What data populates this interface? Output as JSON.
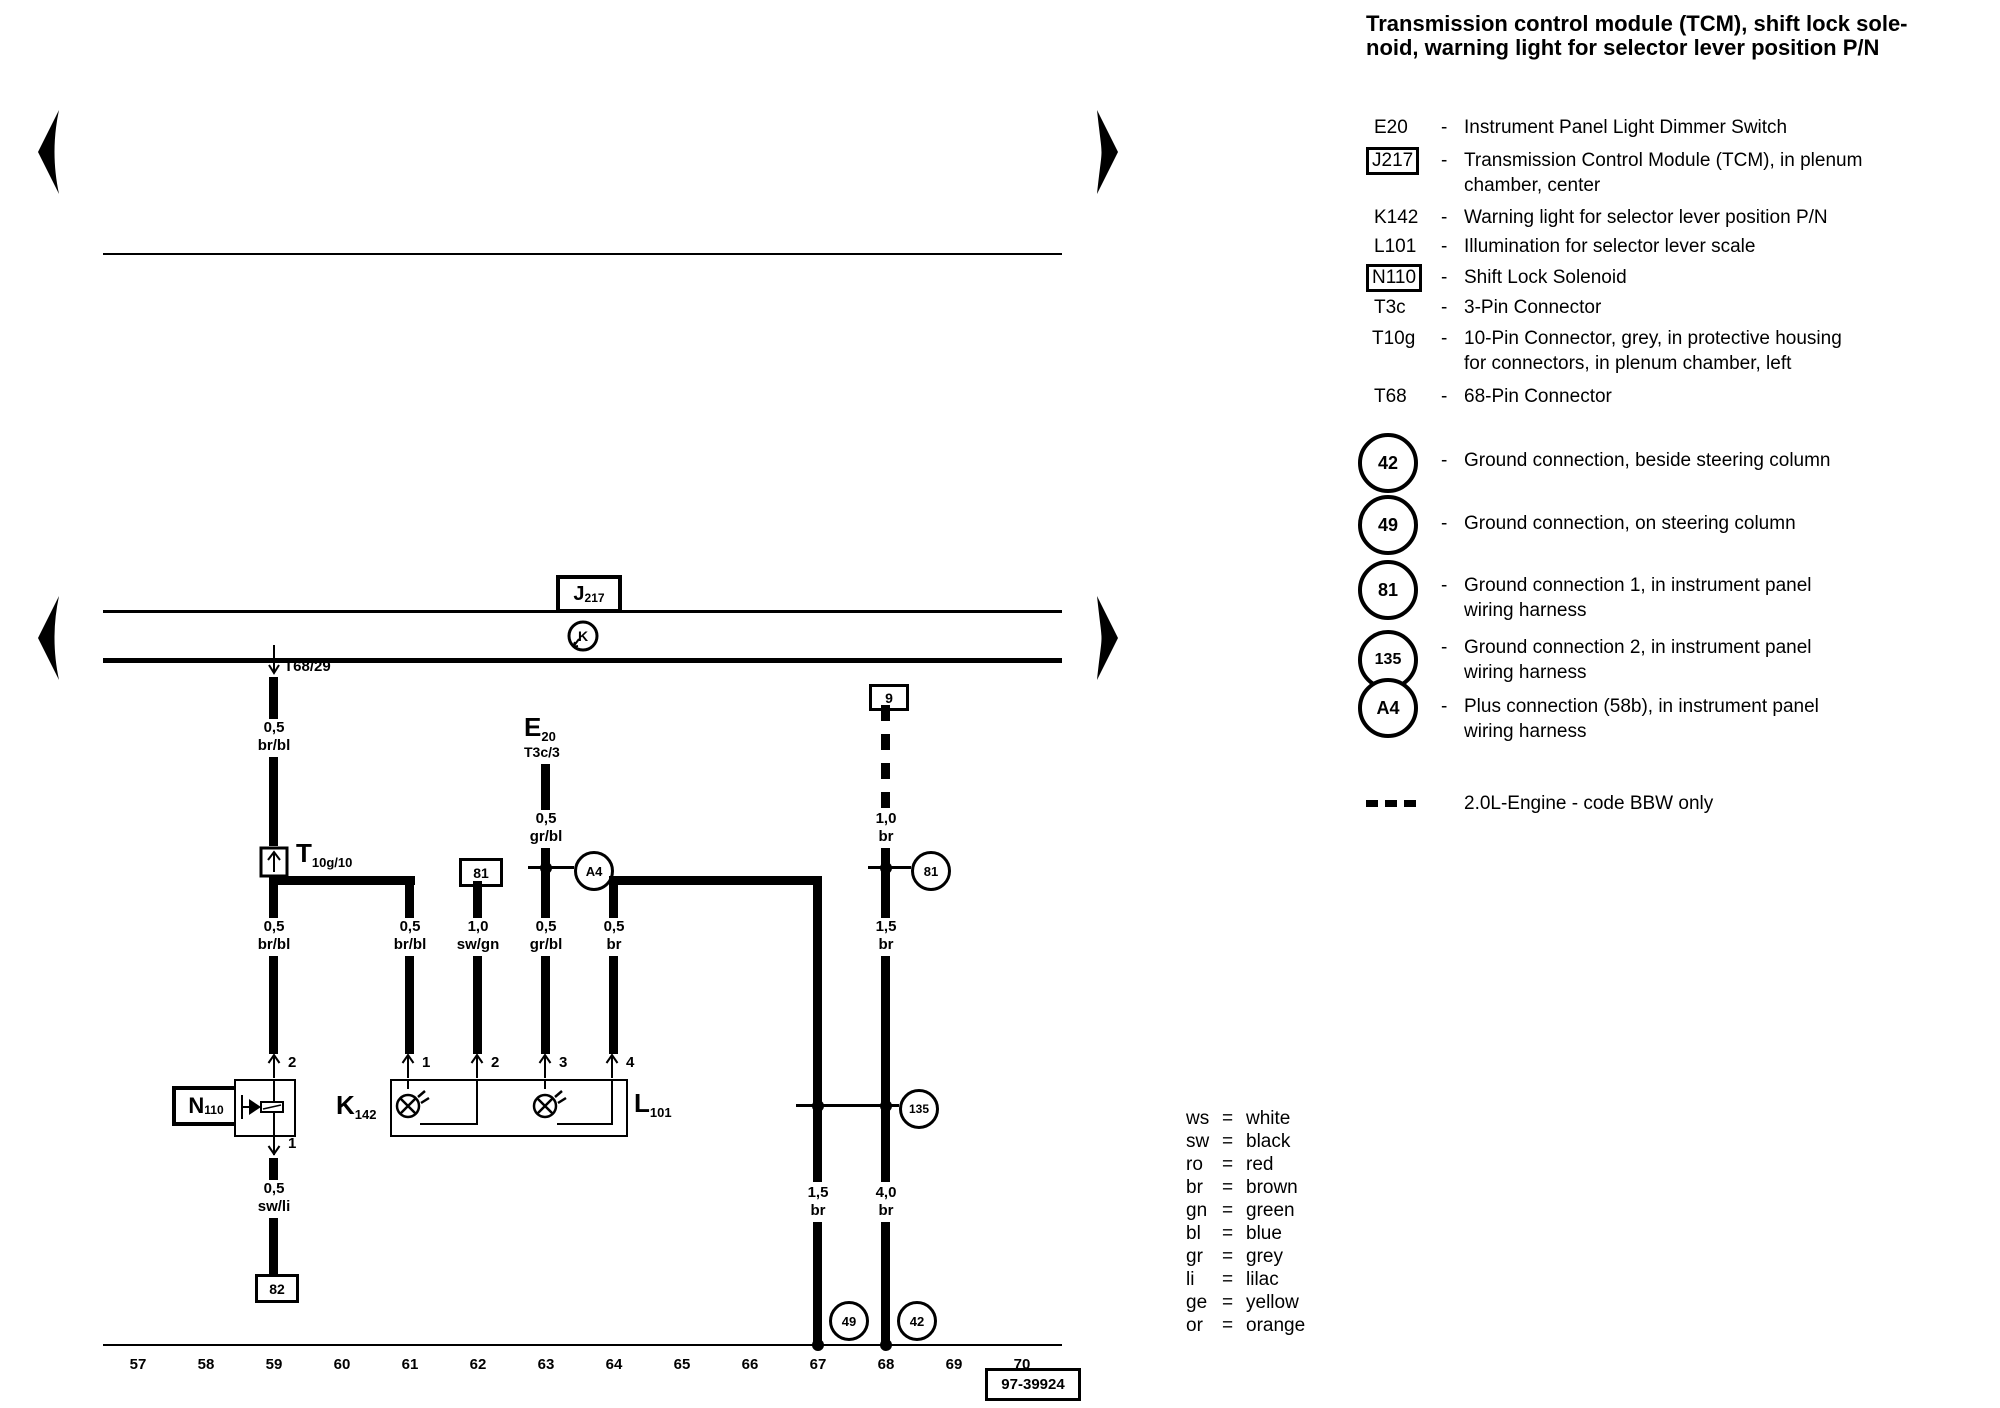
{
  "colors": {
    "ink": "#000000",
    "paper": "#ffffff"
  },
  "title": {
    "line1": "Transmission control module (TCM), shift lock sole-",
    "line2": "noid, warning light for selector lever position P/N"
  },
  "legend": {
    "dash": "-",
    "items": [
      {
        "code": "E20",
        "line1": "Instrument Panel Light Dimmer Switch",
        "line2": ""
      },
      {
        "code": "J217",
        "line1": "Transmission Control Module (TCM), in plenum",
        "line2": "chamber, center"
      },
      {
        "code": "K142",
        "line1": "Warning light for selector lever position P/N",
        "line2": ""
      },
      {
        "code": "L101",
        "line1": "Illumination for selector lever scale",
        "line2": ""
      },
      {
        "code": "N110",
        "line1": "Shift Lock Solenoid",
        "line2": ""
      },
      {
        "code": "T3c",
        "line1": "3-Pin Connector",
        "line2": ""
      },
      {
        "code": "T10g",
        "line1": "10-Pin Connector, grey, in protective housing",
        "line2": "for connectors, in plenum chamber, left"
      },
      {
        "code": "T68",
        "line1": "68-Pin Connector",
        "line2": ""
      }
    ]
  },
  "grounds": {
    "dash": "-",
    "items": [
      {
        "id": "42",
        "line1": "Ground connection, beside steering column",
        "line2": ""
      },
      {
        "id": "49",
        "line1": "Ground connection, on steering column",
        "line2": ""
      },
      {
        "id": "81",
        "line1": "Ground connection 1, in instrument panel",
        "line2": "wiring harness"
      },
      {
        "id": "135",
        "line1": "Ground connection 2, in instrument panel",
        "line2": "wiring harness"
      },
      {
        "id": "A4",
        "line1": "Plus connection (58b), in instrument panel",
        "line2": "wiring harness"
      }
    ]
  },
  "engine_note": "2.0L-Engine - code BBW only",
  "wire_colors": {
    "equals": "=",
    "items": [
      {
        "abbr": "ws",
        "name": "white"
      },
      {
        "abbr": "sw",
        "name": "black"
      },
      {
        "abbr": "ro",
        "name": "red"
      },
      {
        "abbr": "br",
        "name": "brown"
      },
      {
        "abbr": "gn",
        "name": "green"
      },
      {
        "abbr": "bl",
        "name": "blue"
      },
      {
        "abbr": "gr",
        "name": "grey"
      },
      {
        "abbr": "li",
        "name": "lilac"
      },
      {
        "abbr": "ge",
        "name": "yellow"
      },
      {
        "abbr": "or",
        "name": "orange"
      }
    ]
  },
  "diagram": {
    "j217": {
      "letter": "J",
      "sub": "217"
    },
    "k_symbol": "K",
    "t68_pin": "T68/29",
    "t10g": {
      "letter": "T",
      "sub": "10g/10"
    },
    "e20": {
      "letter": "E",
      "sub": "20",
      "pin": "T3c/3"
    },
    "n110": {
      "letter": "N",
      "sub": "110"
    },
    "k142": {
      "letter": "K",
      "sub": "142"
    },
    "l101": {
      "letter": "L",
      "sub": "101"
    },
    "boxes": {
      "b9": "9",
      "b81": "81",
      "b82": "82",
      "ref": "97-39924"
    },
    "circles": {
      "c81": "81",
      "c135": "135",
      "c49": "49",
      "c42": "42",
      "a4": "A4"
    },
    "pins": {
      "n110_top": "2",
      "n110_bottom": "1",
      "p1": "1",
      "p2": "2",
      "p3": "3",
      "p4": "4"
    },
    "wires": {
      "t59a": {
        "size": "0,5",
        "color": "br/bl"
      },
      "t59b": {
        "size": "0,5",
        "color": "br/bl"
      },
      "t61": {
        "size": "0,5",
        "color": "br/bl"
      },
      "t62": {
        "size": "1,0",
        "color": "sw/gn"
      },
      "t63a": {
        "size": "0,5",
        "color": "gr/bl"
      },
      "t63b": {
        "size": "0,5",
        "color": "gr/bl"
      },
      "t64": {
        "size": "0,5",
        "color": "br"
      },
      "t67": {
        "size": "1,5",
        "color": "br"
      },
      "t68a": {
        "size": "1,0",
        "color": "br"
      },
      "t68b": {
        "size": "1,5",
        "color": "br"
      },
      "t68c": {
        "size": "4,0",
        "color": "br"
      },
      "n110w": {
        "size": "0,5",
        "color": "sw/li"
      }
    },
    "tracks": [
      "57",
      "58",
      "59",
      "60",
      "61",
      "62",
      "63",
      "64",
      "65",
      "66",
      "67",
      "68",
      "69",
      "70"
    ]
  }
}
